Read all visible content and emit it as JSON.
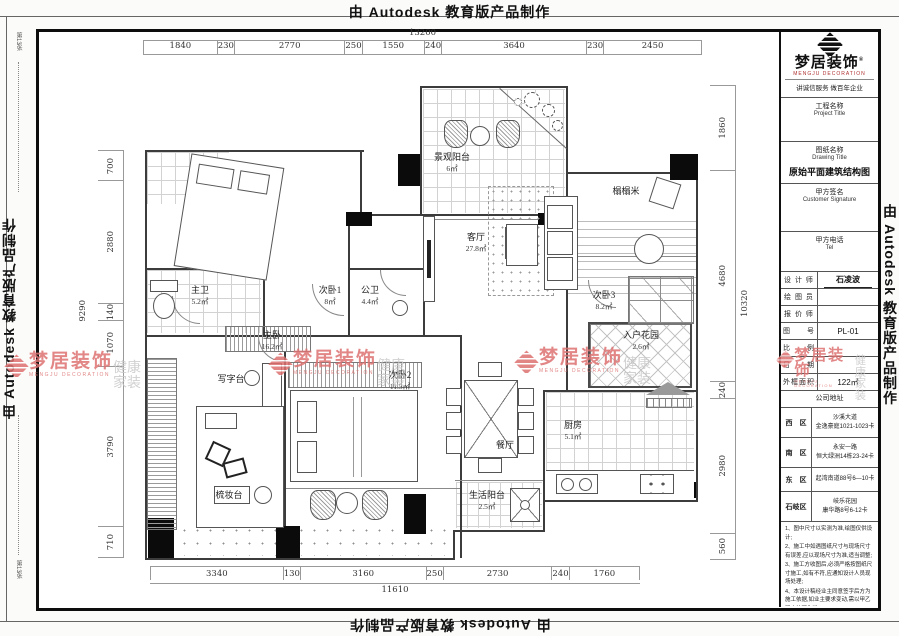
{
  "stamp": {
    "text": "由 Autodesk 教育版产品制作"
  },
  "fold": {
    "label": "第13张"
  },
  "dimensions": {
    "top": {
      "total": "13200",
      "segments": [
        "1840",
        "230",
        "2770",
        "250",
        "1550",
        "240",
        "3640",
        "230",
        "2450"
      ]
    },
    "bottom": {
      "total": "11610",
      "segments": [
        "3340",
        "130",
        "3160",
        "250",
        "2730",
        "240",
        "1760"
      ]
    },
    "left": {
      "total": "9290",
      "segments": [
        "700",
        "2880",
        "140",
        "1070",
        "3790",
        "710"
      ]
    },
    "right": {
      "total": "10320",
      "segments": [
        "1860",
        "4680",
        "240",
        "2980",
        "560"
      ]
    }
  },
  "watermark": {
    "brand": "梦居装饰",
    "brand_en": "MENGJU DECORATION",
    "tag1": "健康",
    "tag2": "家装",
    "red": "#dd7272",
    "gray": "#c9c9c9"
  },
  "rooms": {
    "balcony": {
      "name": "景观阳台",
      "area": "6㎡"
    },
    "tatami": {
      "name": "榻榻米"
    },
    "living": {
      "name": "客厅",
      "area": "27.8㎡"
    },
    "master_bath": {
      "name": "主卫",
      "area": "5.2㎡"
    },
    "bedroom1": {
      "name": "次卧1",
      "area": "8㎡"
    },
    "public_bath": {
      "name": "公卫",
      "area": "4.4㎡"
    },
    "master_bedroom": {
      "name": "主卧",
      "area": "16.2㎡"
    },
    "desk": {
      "name": "写字台"
    },
    "bedroom2": {
      "name": "次卧2",
      "area": "11.5㎡"
    },
    "bedroom3": {
      "name": "次卧3",
      "area": "8.2㎡"
    },
    "entry_garden": {
      "name": "入户花园",
      "area": "2.6㎡"
    },
    "dining": {
      "name": "餐厅"
    },
    "kitchen": {
      "name": "厨房",
      "area": "5.1㎡"
    },
    "utility_balcony": {
      "name": "生活阳台",
      "area": "2.5㎡"
    },
    "dresser": {
      "name": "梳妆台"
    }
  },
  "title_block": {
    "brand": "梦居装饰",
    "reg": "®",
    "brand_en": "MENGJU DECORATION",
    "slogan": "讲诚信服务  做百年企业",
    "project_label": "工程名称",
    "project_label_en": "Project Title",
    "project_value": "",
    "drawing_label": "图纸名称",
    "drawing_label_en": "Drawing Title",
    "drawing_title": "原始平面建筑结构图",
    "sign_label": "甲方签名",
    "sign_label_en": "Customer Signature",
    "tel_label": "甲方电话",
    "tel_label_en": "Tel",
    "rows": [
      {
        "label": "设 计 师",
        "value": "石凌波"
      },
      {
        "label": "绘 图 员",
        "value": ""
      },
      {
        "label": "报 价 师",
        "value": ""
      },
      {
        "label": "图　　号",
        "value": "PL-01"
      },
      {
        "label": "比　　例",
        "value": ""
      },
      {
        "label": "日　　期",
        "value": ""
      },
      {
        "label": "外框面积",
        "value": "122㎡"
      }
    ],
    "addr_header": "公司地址",
    "addresses": [
      {
        "district": "西　区",
        "line1": "沙溪大道",
        "line2": "金逸豪庭1021-1023卡"
      },
      {
        "district": "南　区",
        "line1": "永安一路",
        "line2": "恒大绿洲14栋23-24卡"
      },
      {
        "district": "东　区",
        "line1": "起湾南道88号6—10卡",
        "line2": ""
      },
      {
        "district": "石岐区",
        "line1": "岐乐花园",
        "line2": "康华路8号6-12卡"
      }
    ],
    "notes": [
      "1、图中尺寸以实测为准,绘图仅供设计;",
      "2、施工中如遇图纸尺寸与现场尺寸有误差,应以现场尺寸为准,适当调整;",
      "3、施工方收图后,必须严格按图纸尺寸施工,如有不符,应通知设计人员现场处理;",
      "4、本设计稿经业主同意签字后方为施工依据,如业主要求变动,需以甲乙双方认可为准;",
      "5、全部设计图纸以及相关之版权属于本公司,未经本公司书面同意,不得使用、仿造及复制。"
    ]
  }
}
